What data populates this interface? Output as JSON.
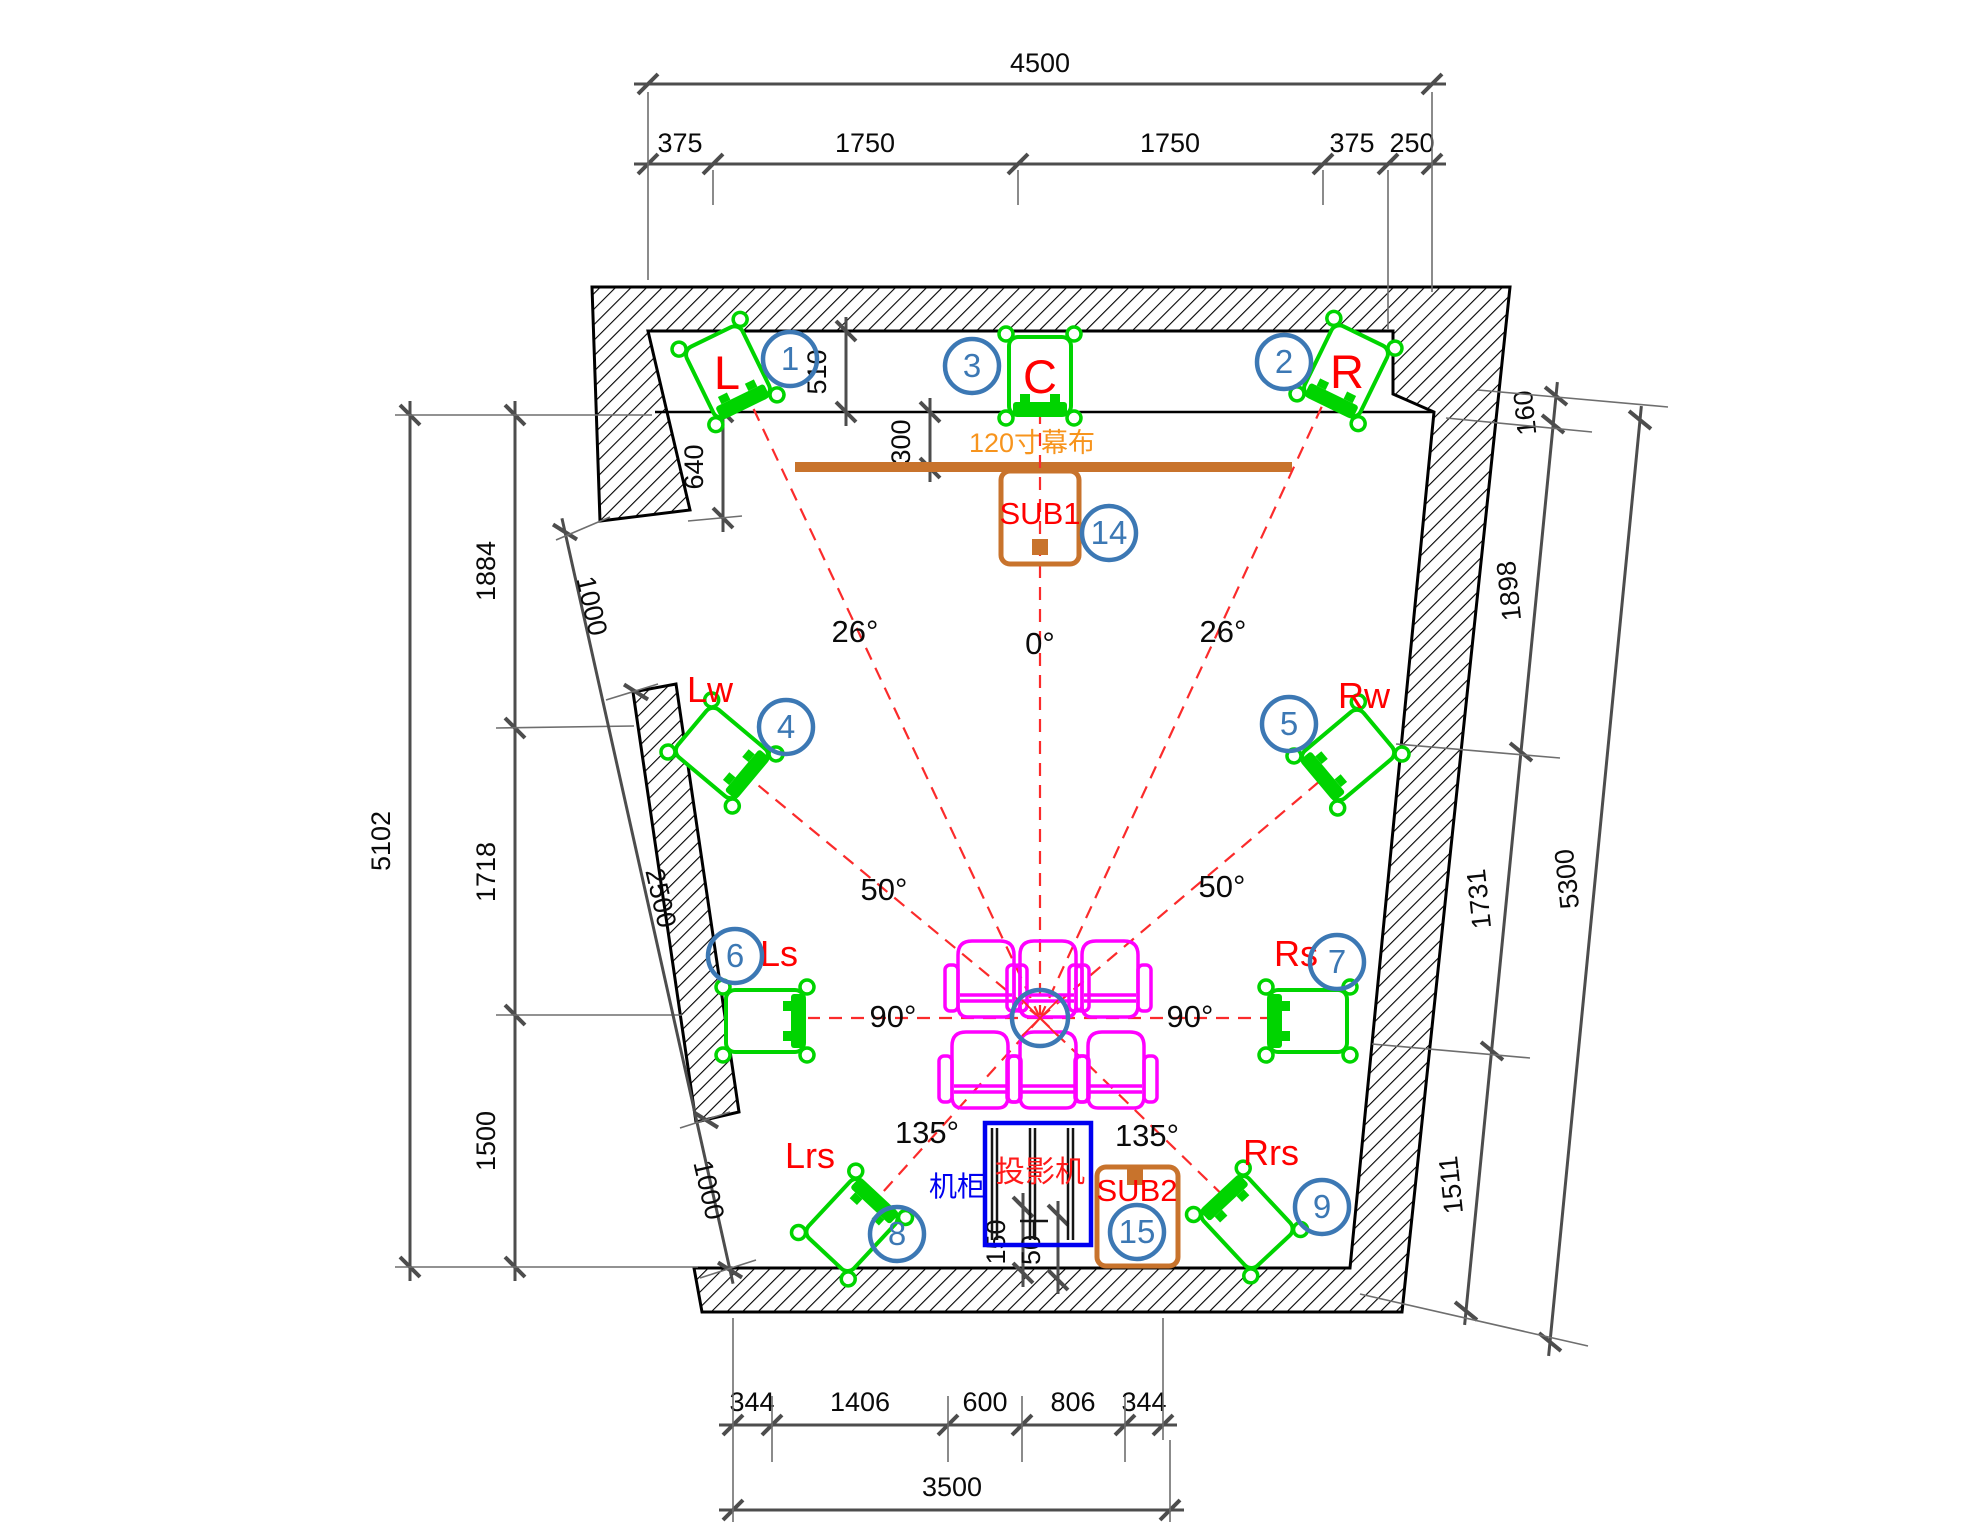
{
  "drawing": {
    "dims": {
      "top_total": "4500",
      "top_segments": [
        "375",
        "1750",
        "1750",
        "375",
        "250"
      ],
      "left_total": "5102",
      "left_segments": [
        "1884",
        "1718",
        "1500"
      ],
      "left_wall_segments": [
        "1000",
        "2500",
        "1000"
      ],
      "right_total": "5300",
      "right_segments": [
        "160",
        "1898",
        "1731",
        "1511"
      ],
      "bottom_segments": [
        "344",
        "1406",
        "600",
        "806",
        "344"
      ],
      "bottom_total": "3500",
      "speaker_zone_depth": "510",
      "screen_to_wall": "300",
      "front_left": "640",
      "rack_dims": [
        "150",
        "50"
      ]
    },
    "angles": {
      "left_front": "26°",
      "center": "0°",
      "right_front": "26°",
      "left_wide": "50°",
      "right_wide": "50°",
      "left_side": "90°",
      "right_side": "90°",
      "left_rear": "135°",
      "right_rear": "135°"
    },
    "speakers": {
      "L": {
        "label": "L",
        "number": "1"
      },
      "C": {
        "label": "C",
        "number": "3"
      },
      "R": {
        "label": "R",
        "number": "2"
      },
      "Lw": {
        "label": "Lw",
        "number": "4"
      },
      "Rw": {
        "label": "Rw",
        "number": "5"
      },
      "Ls": {
        "label": "Ls",
        "number": "6"
      },
      "Rs": {
        "label": "Rs",
        "number": "7"
      },
      "Lrs": {
        "label": "Lrs",
        "number": "8"
      },
      "Rrs": {
        "label": "Rrs",
        "number": "9"
      },
      "SUB1": {
        "label": "SUB1",
        "number": "14"
      },
      "SUB2": {
        "label": "SUB2",
        "number": "15"
      }
    },
    "equipment": {
      "screen": "120寸幕布",
      "projector": "投影机",
      "cabinet": "机柜"
    },
    "colors": {
      "speaker_green": "#00d400",
      "seat_magenta": "#ff00ff",
      "ray_red": "#fb2b2b",
      "label_red": "#ff0000",
      "callout_blue": "#3c78b4",
      "sub_orange": "#c8732c",
      "screen_label_orange": "#f7941d",
      "cabinet_blue": "#0000f0",
      "dim_gray": "#4d4d4d"
    }
  }
}
